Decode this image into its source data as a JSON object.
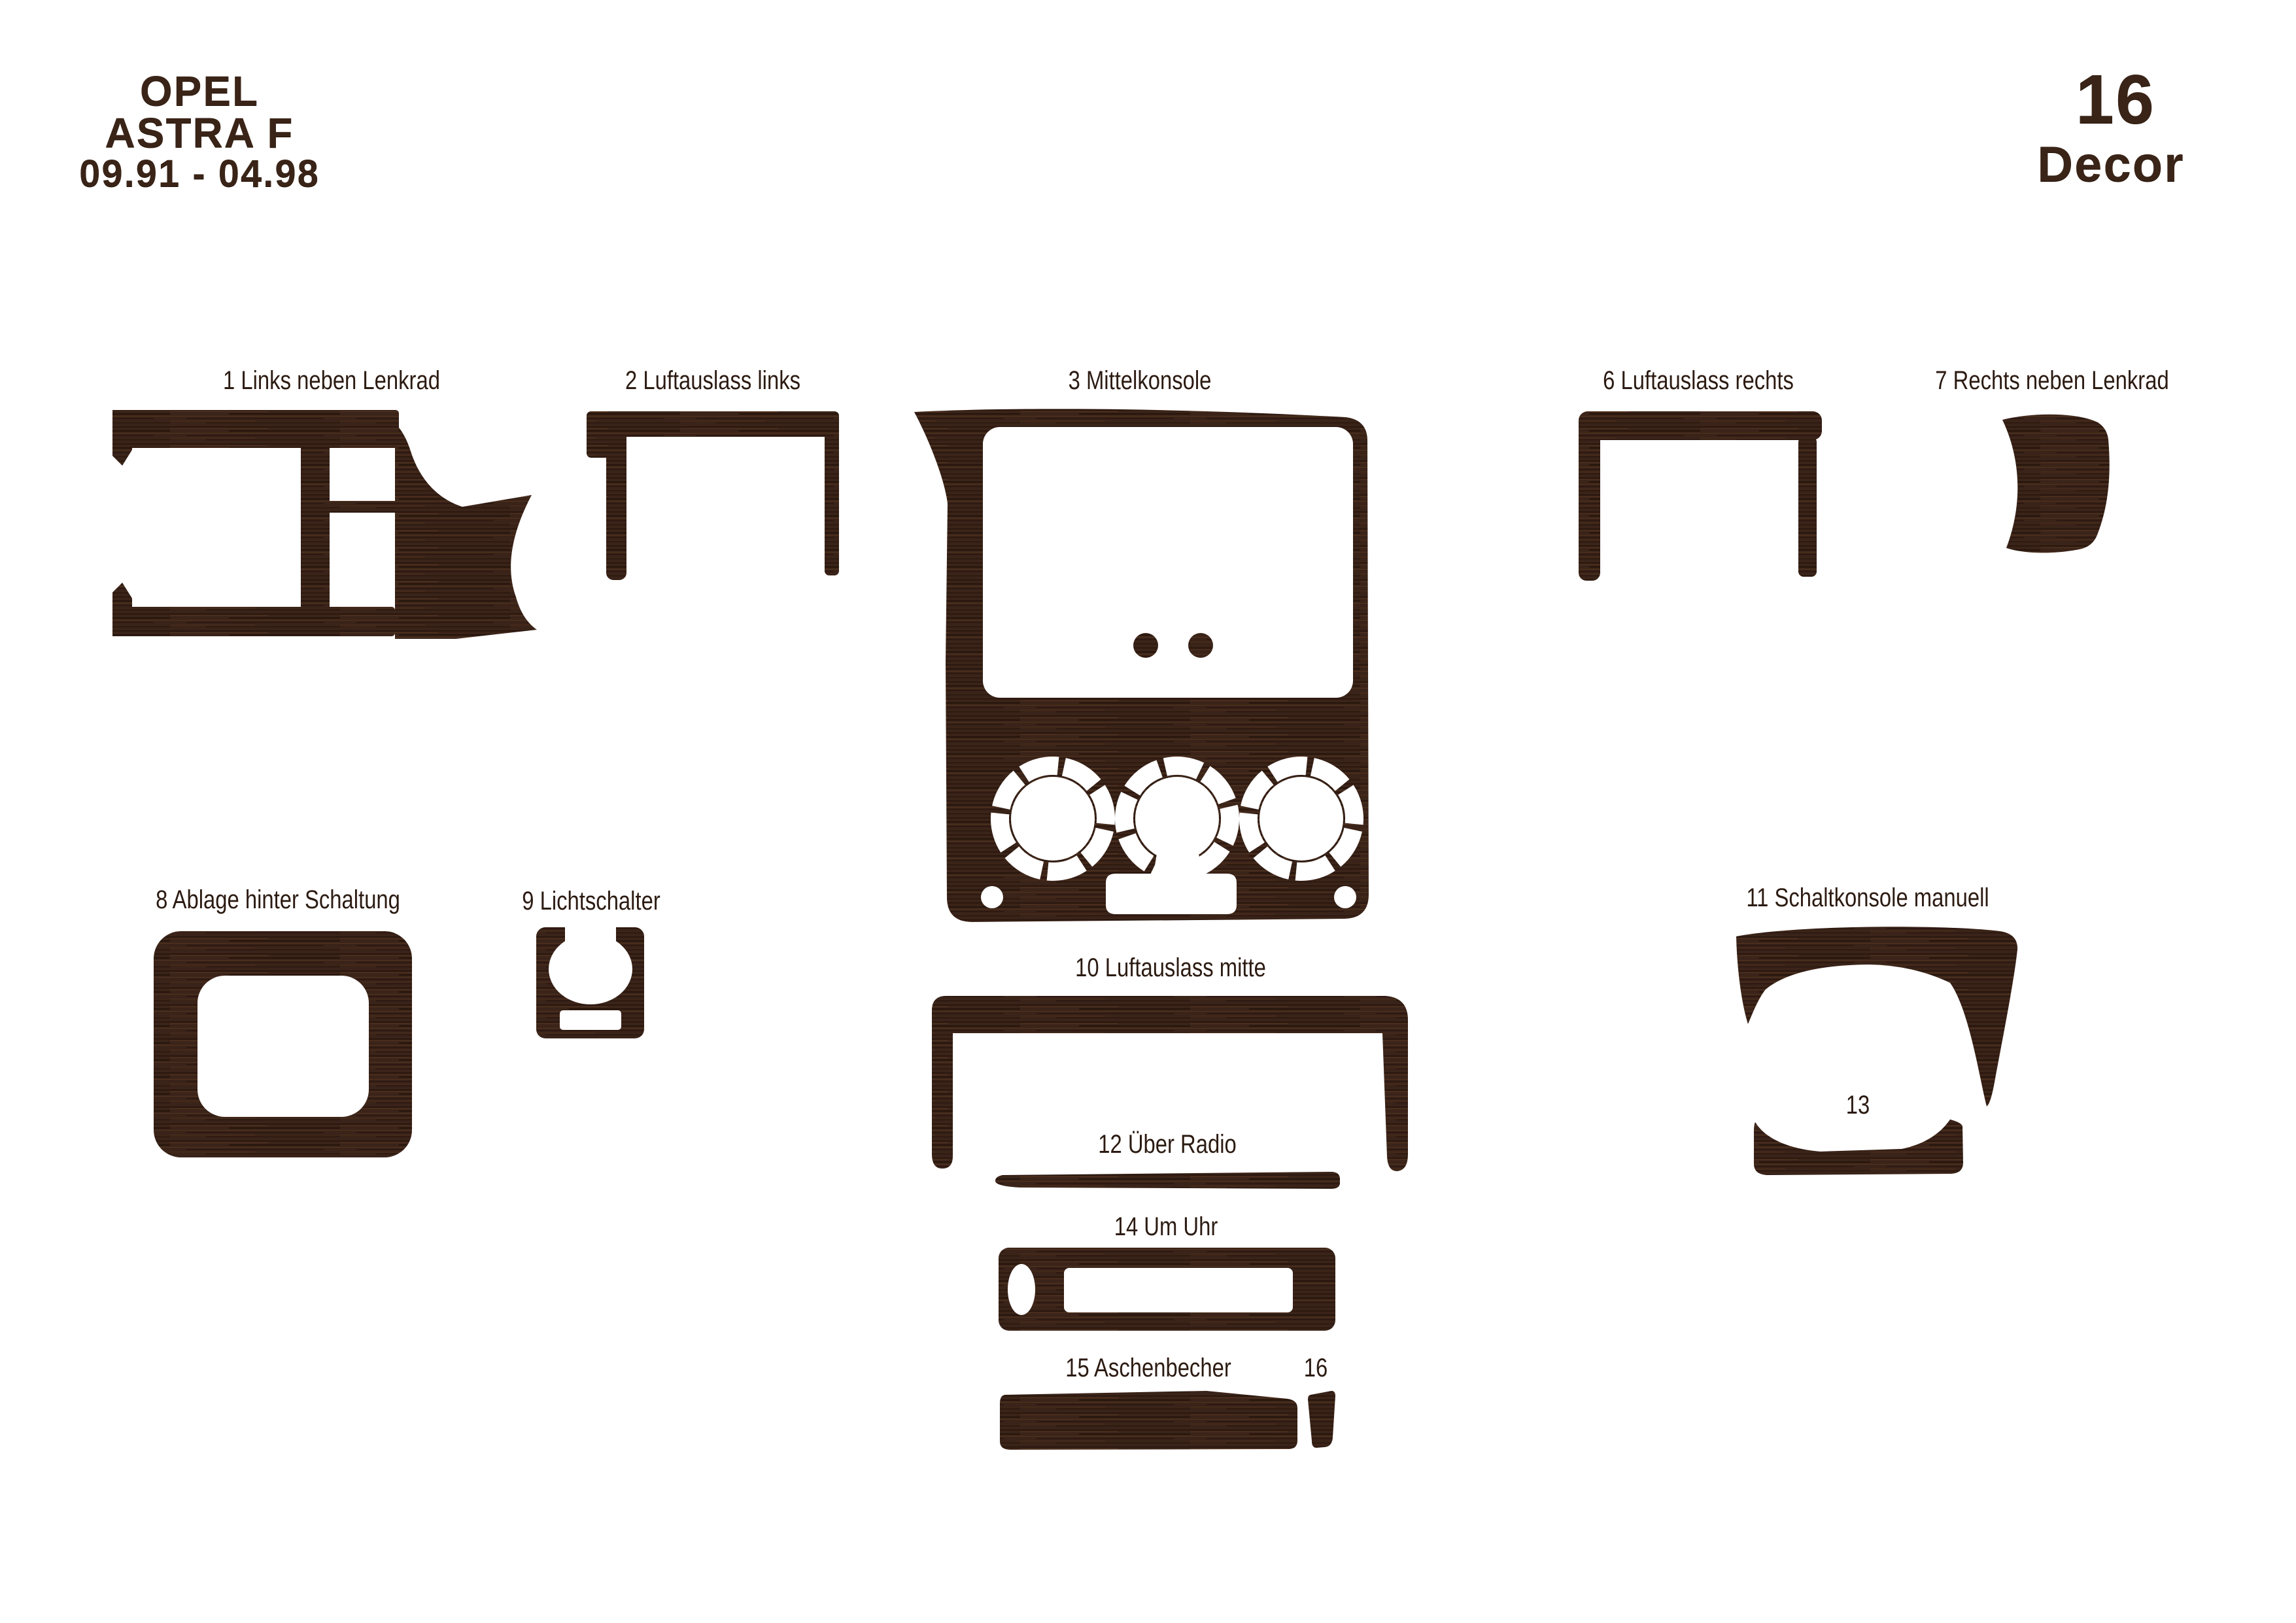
{
  "header": {
    "brand": "OPEL",
    "model": "ASTRA F",
    "years": "09.91 - 04.98"
  },
  "badge": {
    "number": "16",
    "label": "Decor"
  },
  "console_inserts": {
    "title": "Einsatze",
    "left_num": "4",
    "right_num": "5"
  },
  "colors": {
    "background": "#ffffff",
    "wood_base": "#3a2318",
    "wood_dark": "#24130a",
    "wood_light": "#5c3b22",
    "label_text": "#2c1b12"
  },
  "parts": [
    {
      "id": 1,
      "label": "1 Links neben Lenkrad"
    },
    {
      "id": 2,
      "label": "2 Luftauslass links"
    },
    {
      "id": 3,
      "label": "3 Mittelkonsole"
    },
    {
      "id": 6,
      "label": "6 Luftauslass rechts"
    },
    {
      "id": 7,
      "label": "7 Rechts neben Lenkrad"
    },
    {
      "id": 8,
      "label": "8 Ablage hinter Schaltung"
    },
    {
      "id": 9,
      "label": "9 Lichtschalter"
    },
    {
      "id": 10,
      "label": "10 Luftauslass mitte"
    },
    {
      "id": 11,
      "label": "11 Schaltkonsole manuell"
    },
    {
      "id": 12,
      "label": "12 Über Radio"
    },
    {
      "id": 13,
      "label": "13"
    },
    {
      "id": 14,
      "label": "14 Um Uhr"
    },
    {
      "id": 15,
      "label": "15 Aschenbecher"
    },
    {
      "id": 16,
      "label": "16"
    }
  ]
}
